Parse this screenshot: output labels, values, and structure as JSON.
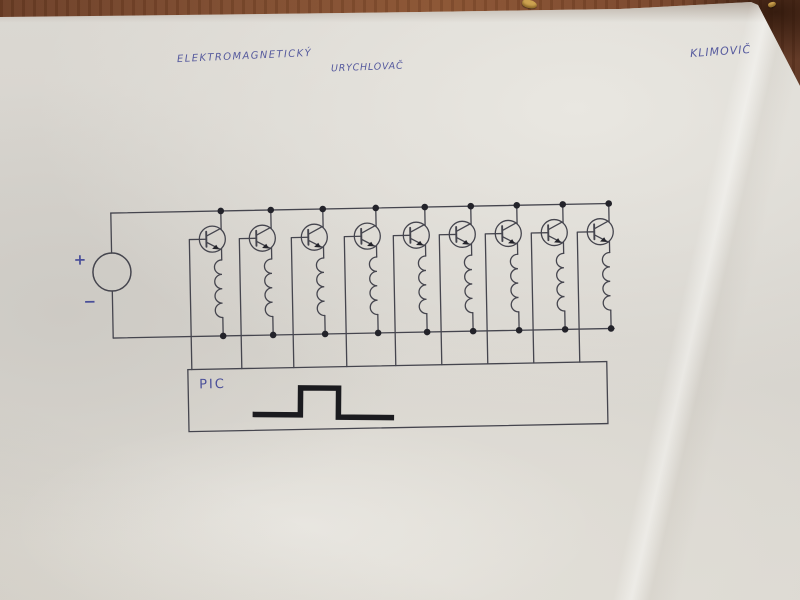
{
  "scene": {
    "surface": "wooden-table",
    "table_color": "#7d4a2d",
    "paper_color": "#d8d5cf",
    "pencil_color": "#45454e",
    "ink_color": "#4a4f99",
    "marker_color": "#1b1b1f"
  },
  "handwriting": {
    "title_line1": "ELEKTROMAGNETICKÝ",
    "title_line2": "URYCHLOVAČ",
    "author": "KLIMOVIČ"
  },
  "schematic": {
    "power_source": {
      "plus": "+",
      "minus": "−"
    },
    "controller": {
      "label": "PIC",
      "waveform": "single-square-pulse"
    },
    "stages": {
      "count": 9,
      "element": "transistor-driving-coil-base-to-controller",
      "x_positions": [
        222,
        272,
        324,
        377,
        426,
        472,
        518,
        564,
        610
      ]
    }
  }
}
